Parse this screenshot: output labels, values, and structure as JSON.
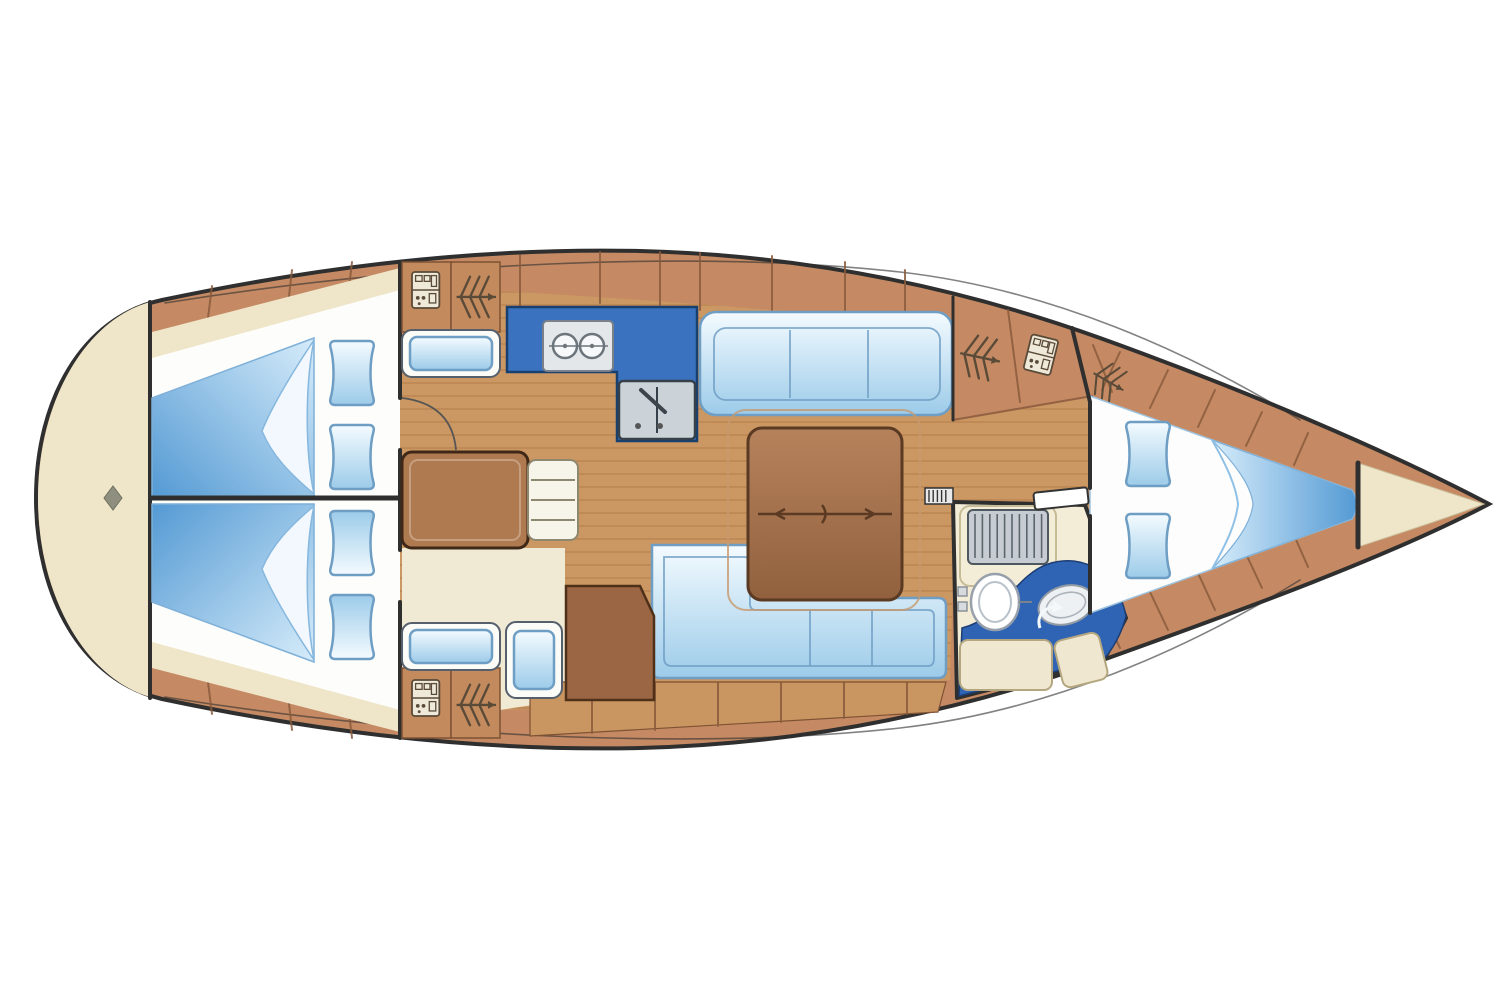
{
  "diagram": {
    "type": "sailboat-interior-deck-plan-top-view",
    "orientation": "bow-right-stern-left",
    "visible_text": [],
    "background": "#ffffff"
  },
  "colors": {
    "background": "#ffffff",
    "hullDeck": "#c58a63",
    "woodFloor": "#cb9763",
    "plank": "#a8713f",
    "lockerWood": "#c28a5d",
    "lockerEdge": "#7e5233",
    "cream": "#efe5c9",
    "creamFloor": "#f0e9d4",
    "headFloor": "#f3ecd6",
    "berthDeep": "#549ad4",
    "berthLight": "#d6ecfa",
    "cushionLight": "#f4fbff",
    "cushionBlue": "#9ccbe9",
    "cushionStroke": "#6f9ec4",
    "galleyCounter": "#3a72bf",
    "galleyEdge": "#17406f",
    "headCounter": "#2f63b4",
    "applianceGray": "#ccd3d8",
    "applianceEdge": "#36404a",
    "tableBrown": "#a9714c",
    "tableEdge": "#5a3a22",
    "outline": "#2f2f2f",
    "seam": "#8a5a3c",
    "iconStroke": "#5a4a38"
  },
  "rooms": [
    {
      "id": "swim-platform-stern",
      "side": "aft"
    },
    {
      "id": "aft-cabin-starboard",
      "berths": 1,
      "pillows": 2
    },
    {
      "id": "aft-cabin-port",
      "berths": 1,
      "pillows": 2
    },
    {
      "id": "companionway-steps",
      "treads": 3
    },
    {
      "id": "galley",
      "stove_burners": 2,
      "sink_basins": 2
    },
    {
      "id": "saloon",
      "settees": 2,
      "tables": 1
    },
    {
      "id": "nav-station",
      "seats": 1
    },
    {
      "id": "head-bathroom",
      "toilet": 1,
      "washbasin": 1,
      "shower_grate": 1
    },
    {
      "id": "v-berth-forward-cabin",
      "berths": 1,
      "pillows": 2
    },
    {
      "id": "anchor-locker-bow",
      "side": "forward"
    }
  ],
  "icons": [
    {
      "name": "hanging-locker-icon",
      "meaning": "wardrobe chevrons with arrow",
      "count": 4
    },
    {
      "name": "shelf-locker-icon",
      "meaning": "cupboard with shelves",
      "count": 3
    },
    {
      "name": "stove-icon",
      "burners": 2
    },
    {
      "name": "galley-sink-icon",
      "basins": 2,
      "faucet": true
    },
    {
      "name": "toilet-icon",
      "count": 1
    },
    {
      "name": "washbasin-icon",
      "count": 1
    },
    {
      "name": "shower-grate-icon",
      "count": 1
    },
    {
      "name": "pillow-icon",
      "count": 6
    },
    {
      "name": "blanket-fold-icon",
      "count": 3
    },
    {
      "name": "table-fold-hinge-icon",
      "count": 1
    },
    {
      "name": "stern-diamond-icon",
      "count": 1
    },
    {
      "name": "door-leaf-icon",
      "count": 2
    },
    {
      "name": "door-swing-arc-icon",
      "count": 2
    }
  ],
  "furniture_counts": {
    "double_berths": 3,
    "settee_straight": 1,
    "settee_L_shaped": 1,
    "saloon_table": 1,
    "nav_table": 1,
    "benches": 3,
    "locker_tiles": 4
  }
}
